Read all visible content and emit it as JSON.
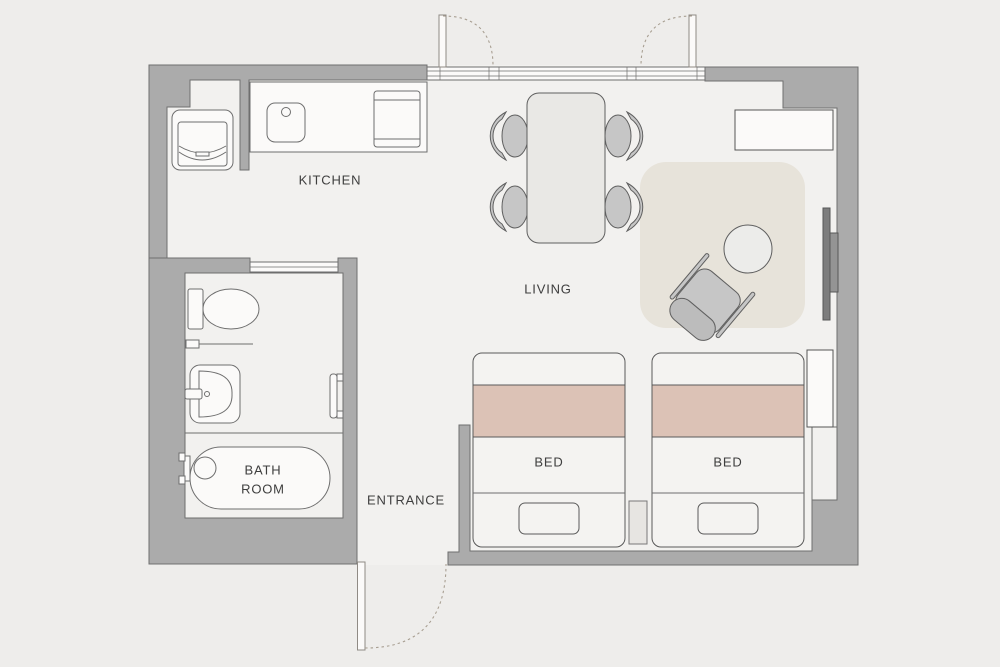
{
  "plan": {
    "labels": {
      "kitchen": "KITCHEN",
      "living": "LIVING",
      "entrance": "ENTRANCE",
      "bath_line1": "BATH",
      "bath_line2": "ROOM",
      "bed_left": "BED",
      "bed_right": "BED"
    },
    "colors": {
      "background": "#eeedeb",
      "floor": "#f2f1ef",
      "wall": "#ababab",
      "wall_outline": "#6f6f6f",
      "fixture_white": "#fbfaf9",
      "bed_blanket_accent": "#dcc2b6",
      "rug": "#e7e3da",
      "furniture_gray": "#c6c6c6",
      "tv_screen": "#7d7d7d",
      "door_swing_dotted": "#a89f92",
      "label_text": "#3e3e3e"
    }
  }
}
